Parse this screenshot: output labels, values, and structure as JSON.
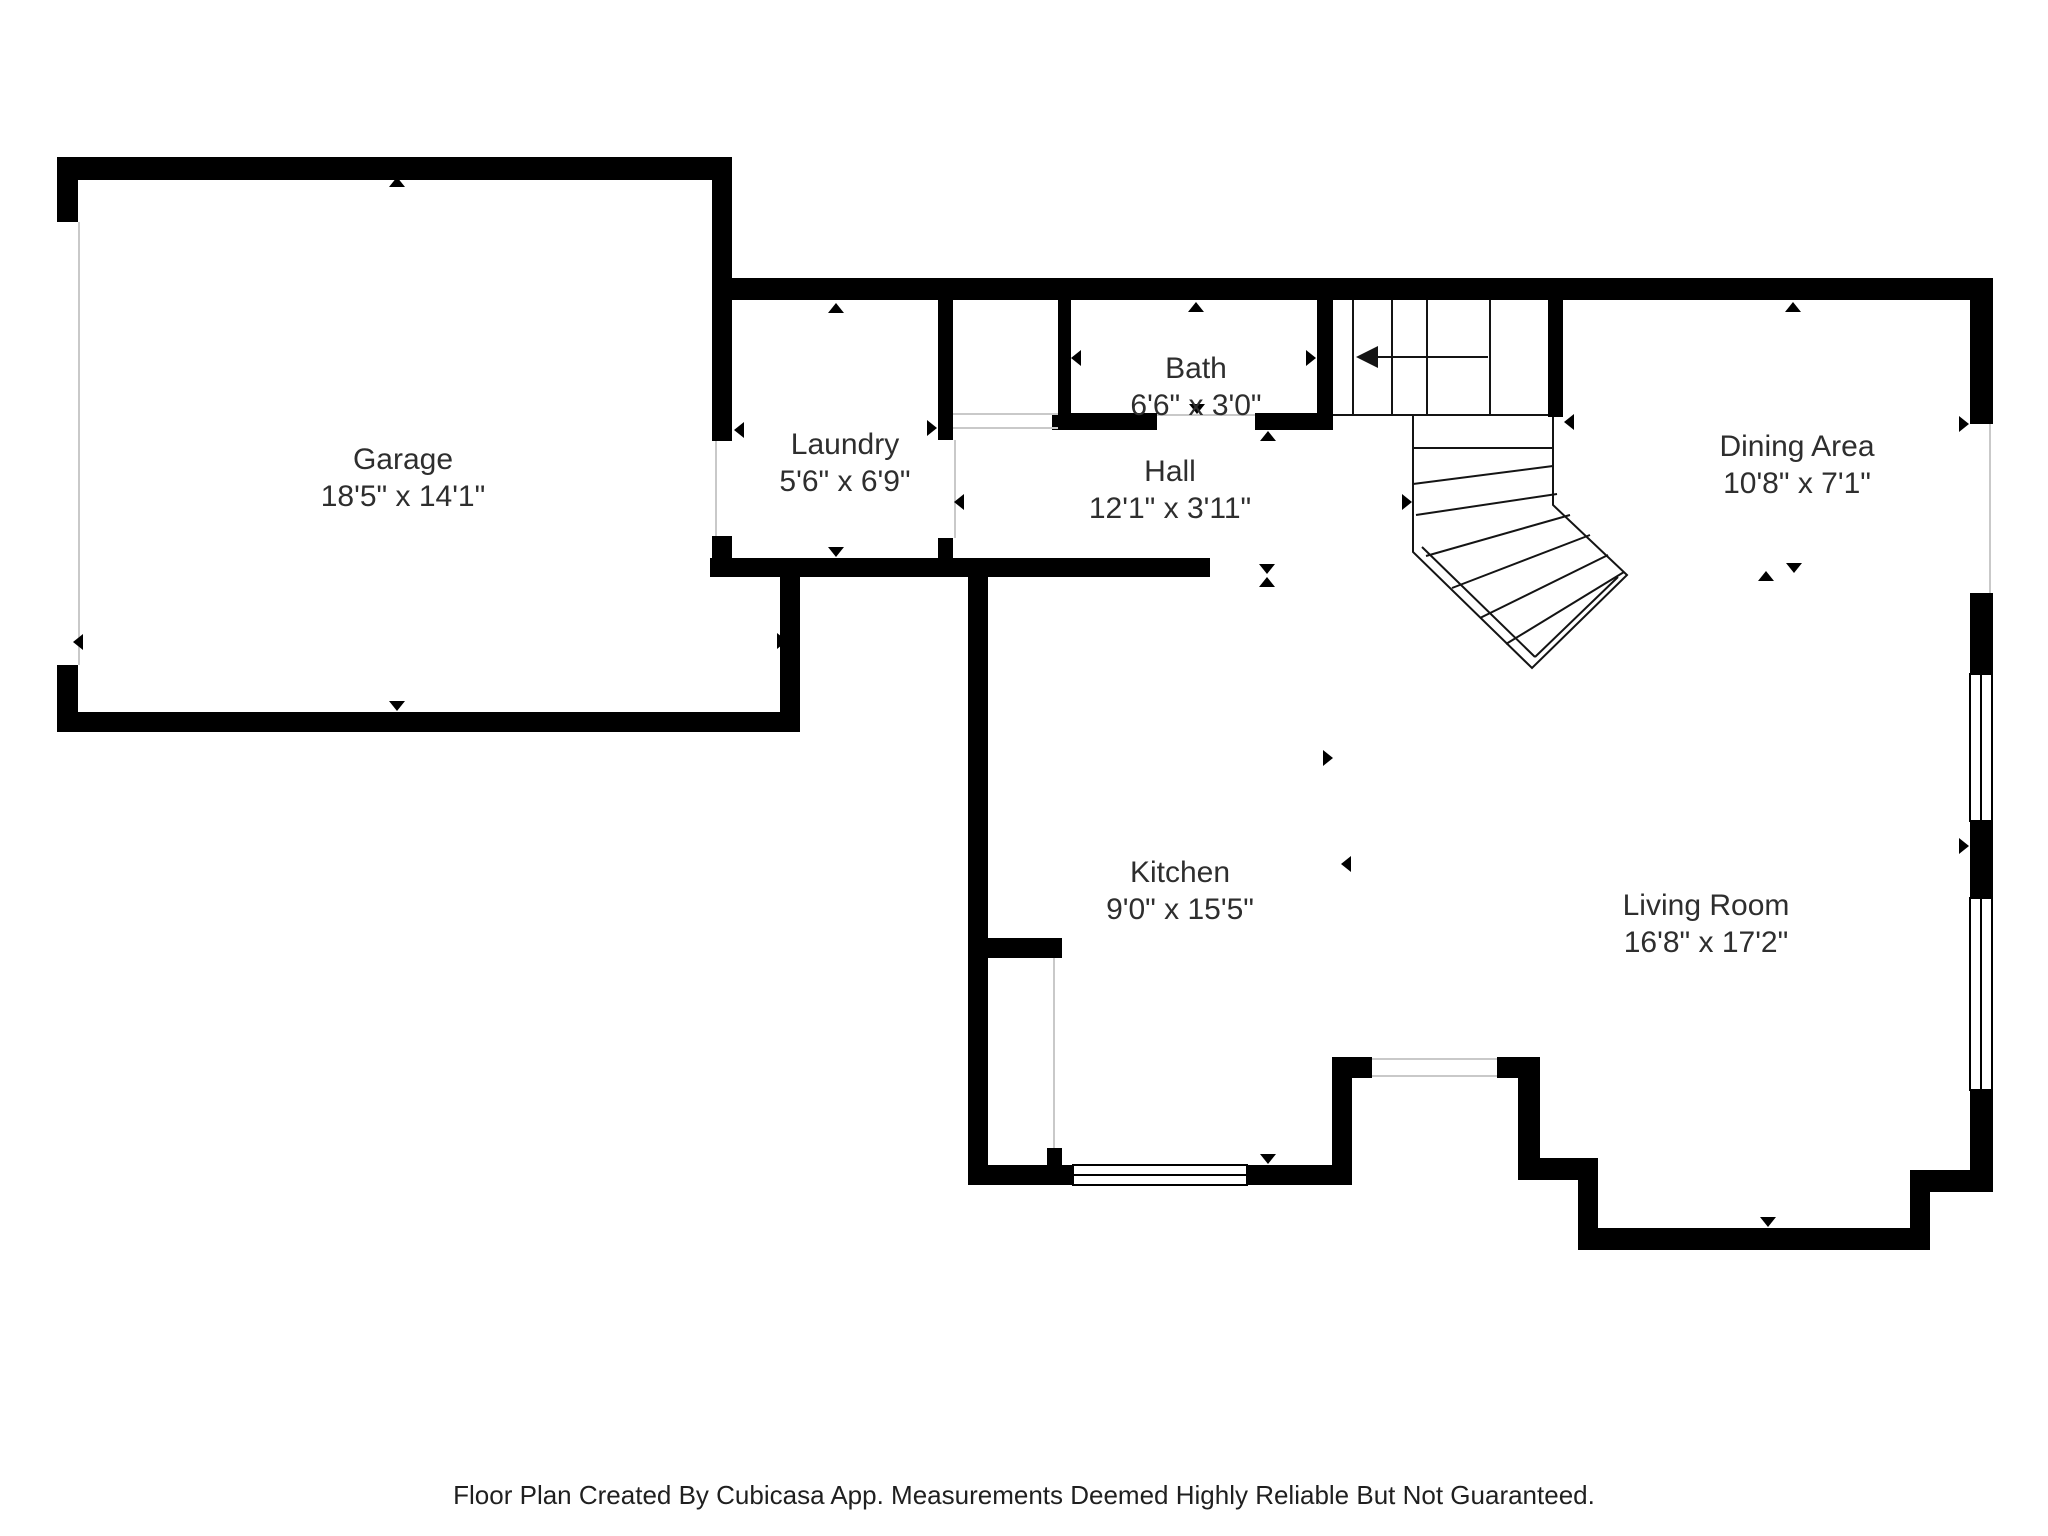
{
  "colors": {
    "wall": "#000000",
    "stair_line": "#141414",
    "opening_line": "#c9c9c9",
    "text": "#2e2e2e"
  },
  "rooms": [
    {
      "id": "garage",
      "name": "Garage",
      "dims": "18'5\" x 14'1\""
    },
    {
      "id": "laundry",
      "name": "Laundry",
      "dims": "5'6\" x 6'9\""
    },
    {
      "id": "bath",
      "name": "Bath",
      "dims": "6'6\" x 3'0\""
    },
    {
      "id": "hall",
      "name": "Hall",
      "dims": "12'1\" x 3'11\""
    },
    {
      "id": "dining",
      "name": "Dining Area",
      "dims": "10'8\" x 7'1\""
    },
    {
      "id": "kitchen",
      "name": "Kitchen",
      "dims": "9'0\" x 15'5\""
    },
    {
      "id": "living",
      "name": "Living Room",
      "dims": "16'8\" x 17'2\""
    }
  ],
  "footer": {
    "text": "Floor Plan Created By Cubicasa App. Measurements Deemed Highly Reliable But Not Guaranteed."
  },
  "markers": [
    {
      "d": "up",
      "x": 397,
      "y": 177
    },
    {
      "d": "down",
      "x": 397,
      "y": 711
    },
    {
      "d": "left",
      "x": 73,
      "y": 642
    },
    {
      "d": "right",
      "x": 787,
      "y": 641
    },
    {
      "d": "up",
      "x": 836,
      "y": 303
    },
    {
      "d": "down",
      "x": 836,
      "y": 557
    },
    {
      "d": "left",
      "x": 734,
      "y": 430
    },
    {
      "d": "right",
      "x": 937,
      "y": 428
    },
    {
      "d": "up",
      "x": 1196,
      "y": 302
    },
    {
      "d": "down",
      "x": 1197,
      "y": 414
    },
    {
      "d": "left",
      "x": 1071,
      "y": 358
    },
    {
      "d": "right",
      "x": 1316,
      "y": 358
    },
    {
      "d": "up",
      "x": 1268,
      "y": 431
    },
    {
      "d": "left",
      "x": 954,
      "y": 502
    },
    {
      "d": "right",
      "x": 1412,
      "y": 502
    },
    {
      "d": "down",
      "x": 1267,
      "y": 574
    },
    {
      "d": "up",
      "x": 1267,
      "y": 577
    },
    {
      "d": "up",
      "x": 1793,
      "y": 302
    },
    {
      "d": "left",
      "x": 1564,
      "y": 422
    },
    {
      "d": "right",
      "x": 1969,
      "y": 424
    },
    {
      "d": "down",
      "x": 1794,
      "y": 573
    },
    {
      "d": "up",
      "x": 1766,
      "y": 571
    },
    {
      "d": "right",
      "x": 1333,
      "y": 758
    },
    {
      "d": "left",
      "x": 1341,
      "y": 864
    },
    {
      "d": "right",
      "x": 1969,
      "y": 846
    },
    {
      "d": "down",
      "x": 1268,
      "y": 1164
    },
    {
      "d": "down",
      "x": 1768,
      "y": 1227
    }
  ]
}
